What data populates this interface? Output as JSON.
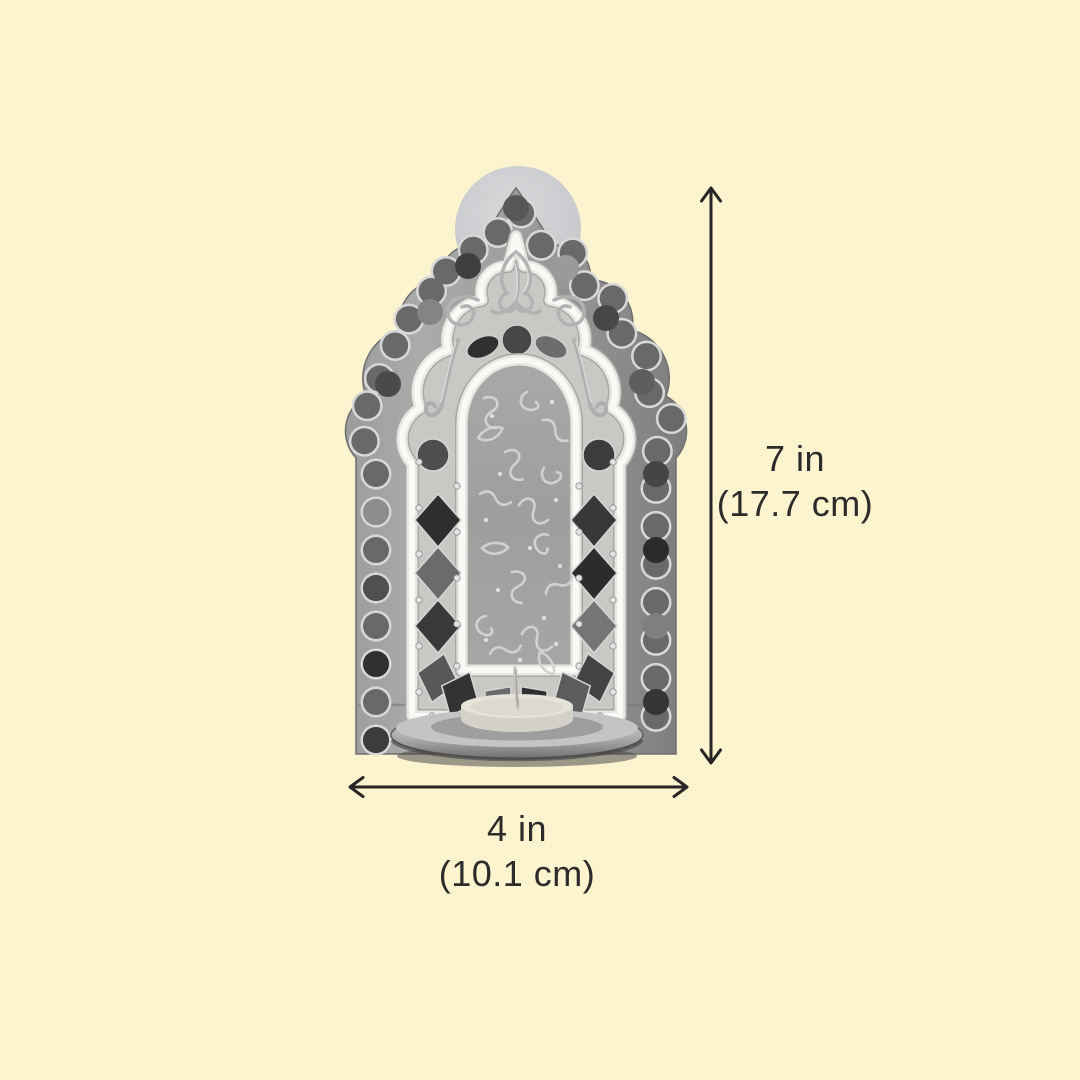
{
  "canvas": {
    "background_color": "#FCF3CF",
    "background_style": "background-color:#FCF3CF",
    "width_px": 1080,
    "height_px": 1080
  },
  "figure": {
    "name": "jharokha-mirror-work-tealight-wall-sconce",
    "rendering": "grayscale product photo with candle plate and tealight"
  },
  "annotations": {
    "arrow_color": "#262626",
    "text_color": "#2C2C2C",
    "height": {
      "inches": "7 in",
      "metric": "(17.7 cm)"
    },
    "width": {
      "inches": "4 in",
      "metric": "(10.1 cm)"
    }
  }
}
